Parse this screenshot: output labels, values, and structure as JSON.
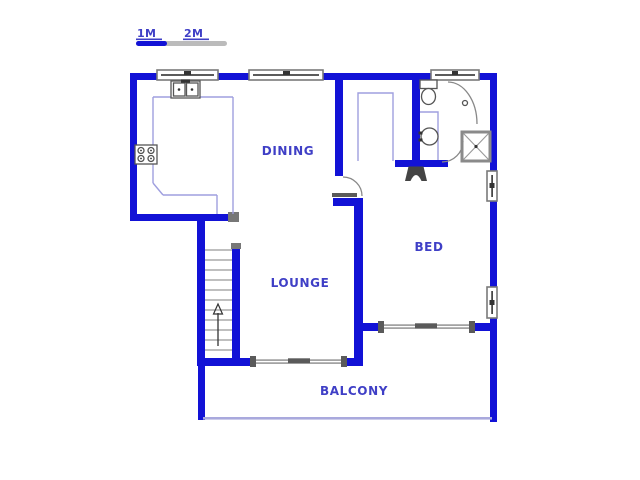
{
  "scale_bar": {
    "label_1m": "1M",
    "label_2m": "2M"
  },
  "rooms": {
    "dining": "DINING",
    "lounge": "LOUNGE",
    "bed": "BED",
    "balcony": "BALCONY"
  },
  "fixtures": [
    "stove",
    "double-sink",
    "kitchen-counter",
    "staircase-up-arrow",
    "toilet",
    "wash-basin",
    "shower",
    "floor-drain",
    "door-swing",
    "sliding-door",
    "window",
    "closet",
    "balcony-railing",
    "vent-fixture"
  ],
  "colors": {
    "background": "#ffffff",
    "wall": "#1212d6",
    "label": "#3f3fc6",
    "counter_line": "#9f9fdf",
    "railing": "#a9a9dd",
    "window_border": "#7a7a7a",
    "fixture_outline": "#555555",
    "door_arc": "#888888",
    "tread": "#999999",
    "jamb_gray": "#5a5a5a",
    "scale_gray": "#bbbbbb",
    "dark_detail": "#333333"
  }
}
